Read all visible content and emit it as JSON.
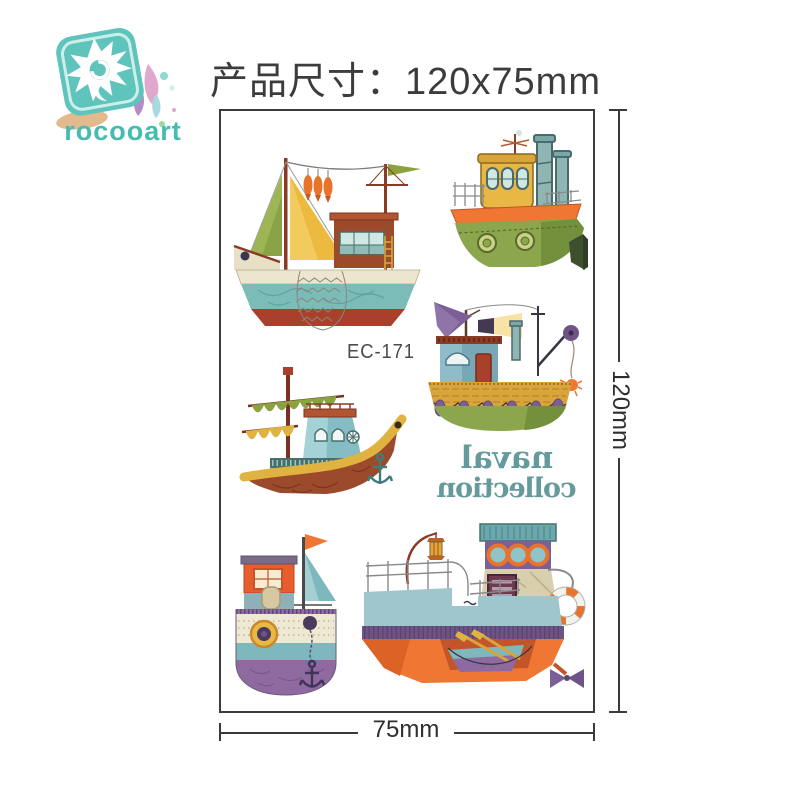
{
  "header": {
    "title": "产品尺寸：120x75mm",
    "logo": {
      "brand": "rocooart",
      "icon": "rocooart-logo"
    }
  },
  "sheet": {
    "product_code": "EC-171",
    "tattoo_text": {
      "line1": "naval",
      "line2": "collection",
      "mirrored": true
    },
    "boats": [
      {
        "name": "fishing sailboat with sails, hanging fish and net"
      },
      {
        "name": "green tugboat with yellow cabin and two smokestacks"
      },
      {
        "name": "trawler with purple sail, searchlight, crane and crab"
      },
      {
        "name": "sail ship with furled sails, teal cabin and anchor"
      },
      {
        "name": "round purple-hull boat front view with sail and flag"
      },
      {
        "name": "orange cargo ship with lantern, lifebuoy, dinghy and propeller"
      }
    ]
  },
  "dimensions": {
    "height_label": "120mm",
    "width_label": "75mm"
  },
  "colors": {
    "brand_teal": "#45bcb2",
    "tattoo_text_teal": "#649a9b",
    "dimension_line": "#3a3a3a",
    "boat_orange": "#ef7733",
    "boat_green": "#8ca64e",
    "boat_yellow": "#e9b744",
    "boat_purple": "#8f6aa0",
    "boat_redbrown": "#9c4a2c",
    "boat_teal": "#7bbcb8"
  }
}
